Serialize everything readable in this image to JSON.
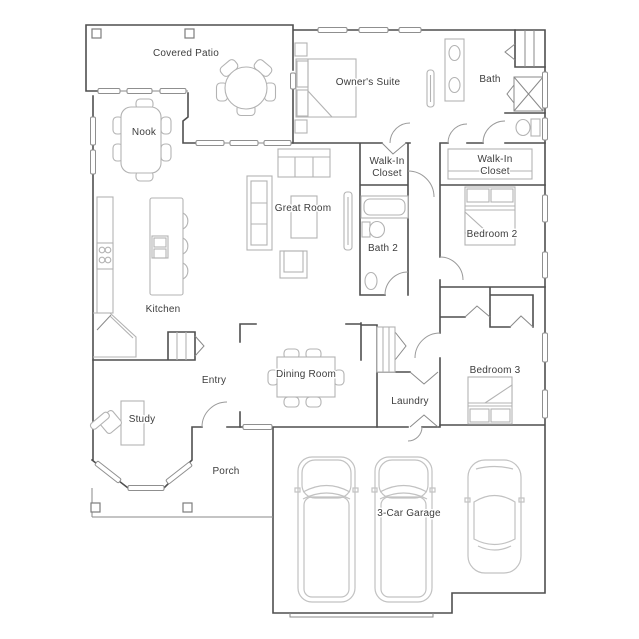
{
  "document": {
    "type": "residential-floor-plan",
    "garage_bays": "3"
  },
  "colors": {
    "wall": "#4f4f4f",
    "thin_line": "#8a8a8a",
    "furniture": "#b3b3b3",
    "vehicle": "#c2c2c2",
    "label": "#3d3d3d",
    "background": "#ffffff"
  },
  "rooms": {
    "covered_patio": {
      "label": "Covered Patio"
    },
    "owners_suite": {
      "label": "Owner's Suite"
    },
    "bath": {
      "label": "Bath"
    },
    "nook": {
      "label": "Nook"
    },
    "walk_in_closet_owner": {
      "line1": "Walk-In",
      "line2": "Closet"
    },
    "walk_in_closet_2": {
      "line1": "Walk-In",
      "line2": "Closet"
    },
    "great_room": {
      "label": "Great Room"
    },
    "bath_2": {
      "label": "Bath 2"
    },
    "bedroom_2": {
      "label": "Bedroom 2"
    },
    "kitchen": {
      "label": "Kitchen"
    },
    "entry": {
      "label": "Entry"
    },
    "dining_room": {
      "label": "Dining Room"
    },
    "laundry": {
      "label": "Laundry"
    },
    "bedroom_3": {
      "label": "Bedroom 3"
    },
    "study": {
      "label": "Study"
    },
    "porch": {
      "label": "Porch"
    },
    "garage": {
      "label": "3-Car Garage"
    }
  }
}
